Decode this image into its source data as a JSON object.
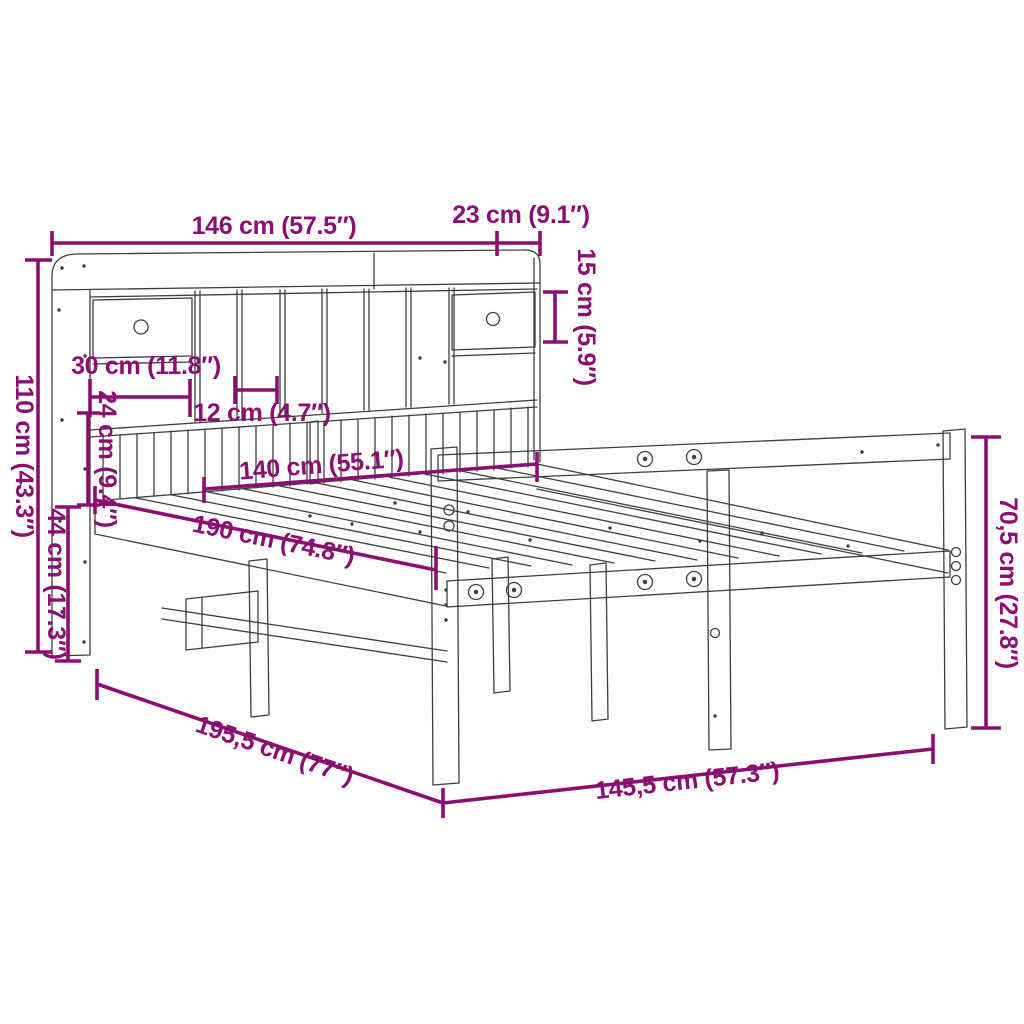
{
  "title": "Bookcase bed frame dimension diagram",
  "colors": {
    "background": "#ffffff",
    "line": "#3e3e3e",
    "dimension": "#8B0F70"
  },
  "dimensions": {
    "headboard_width": {
      "label": "146 cm (57.5″)",
      "orientation": "horizontal"
    },
    "shelf_side_depth": {
      "label": "23 cm (9.1″)",
      "orientation": "horizontal"
    },
    "top_shelf_height": {
      "label": "15 cm (5.9″)",
      "orientation": "vertical"
    },
    "headboard_height": {
      "label": "110 cm (43.3″)",
      "orientation": "vertical"
    },
    "drawer_width": {
      "label": "30 cm (11.8″)",
      "orientation": "horizontal"
    },
    "cubby_width": {
      "label": "12 cm (4.7″)",
      "orientation": "horizontal"
    },
    "slat_panel_height": {
      "label": "24 cm (9.4″)",
      "orientation": "vertical"
    },
    "platform_height": {
      "label": "44 cm (17.3″)",
      "orientation": "vertical"
    },
    "mattress_width": {
      "label": "140 cm (55.1″)",
      "orientation": "diagonal"
    },
    "mattress_length": {
      "label": "190 cm (74.8″)",
      "orientation": "diagonal"
    },
    "footboard_height": {
      "label": "70,5 cm (27.8″)",
      "orientation": "vertical"
    },
    "frame_length": {
      "label": "195,5 cm (77″)",
      "orientation": "diagonal"
    },
    "frame_width": {
      "label": "145,5 cm (57.3″)",
      "orientation": "diagonal"
    }
  }
}
